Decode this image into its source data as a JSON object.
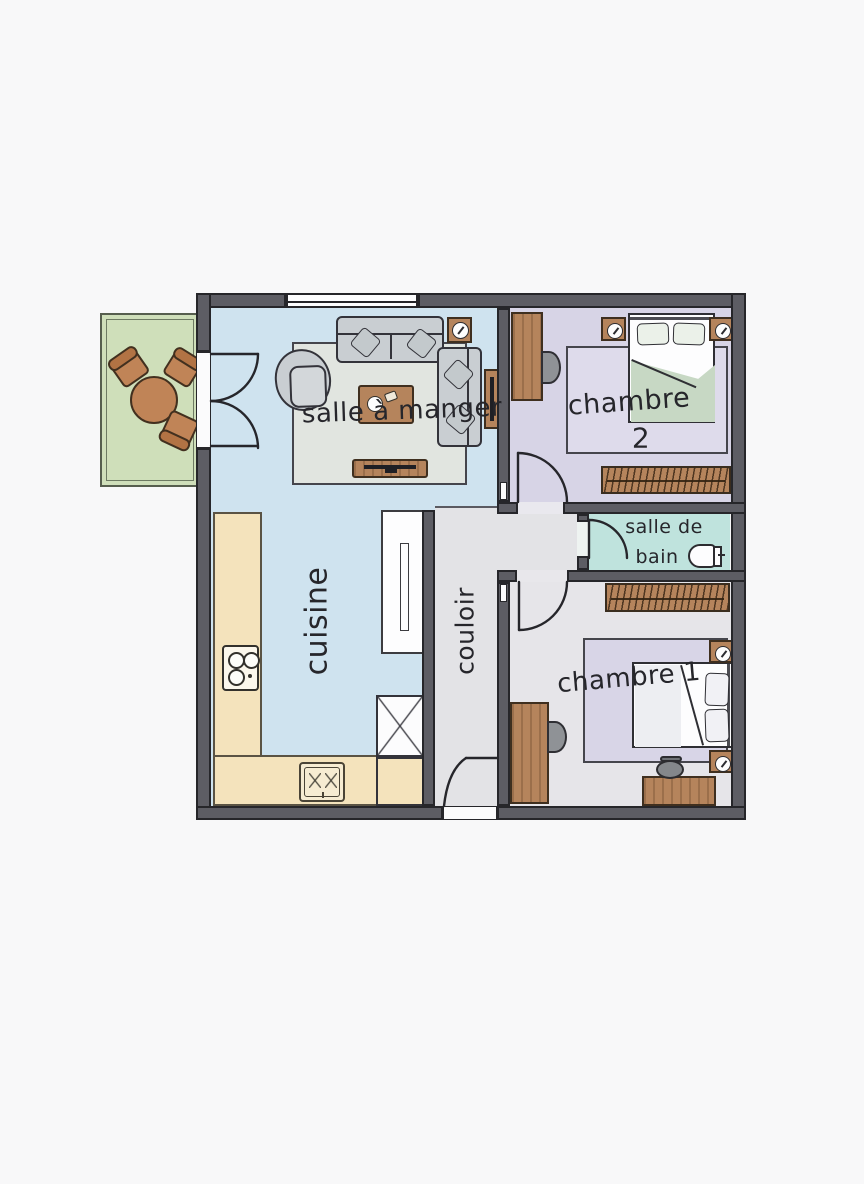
{
  "plan": {
    "type": "apartment-floor-plan",
    "language": "French",
    "rooms": {
      "dining": {
        "label": "salle à manger"
      },
      "bedroom2": {
        "line1": "chambre",
        "line2": "2"
      },
      "bathroom": {
        "line1": "salle de",
        "line2": "bain"
      },
      "kitchen": {
        "label": "cuisine"
      },
      "hallway": {
        "label": "couloir"
      },
      "bedroom1": {
        "label": "chambre 1"
      }
    },
    "colors": {
      "wall": "#5d5d64",
      "floor_living_kitchen": "#cfe3ef",
      "floor_hallway": "#e3e3e6",
      "floor_bedroom2": "#d7d4e6",
      "floor_bedroom1": "#e6e5e9",
      "floor_bathroom": "#bfe3dd",
      "balcony": "#cfdfba",
      "kitchen_counter": "#f4e3bc",
      "wood_furniture": "#b5845c",
      "bed_blanket_green": "#c7d8c4",
      "background": "#f8f8f9"
    }
  }
}
